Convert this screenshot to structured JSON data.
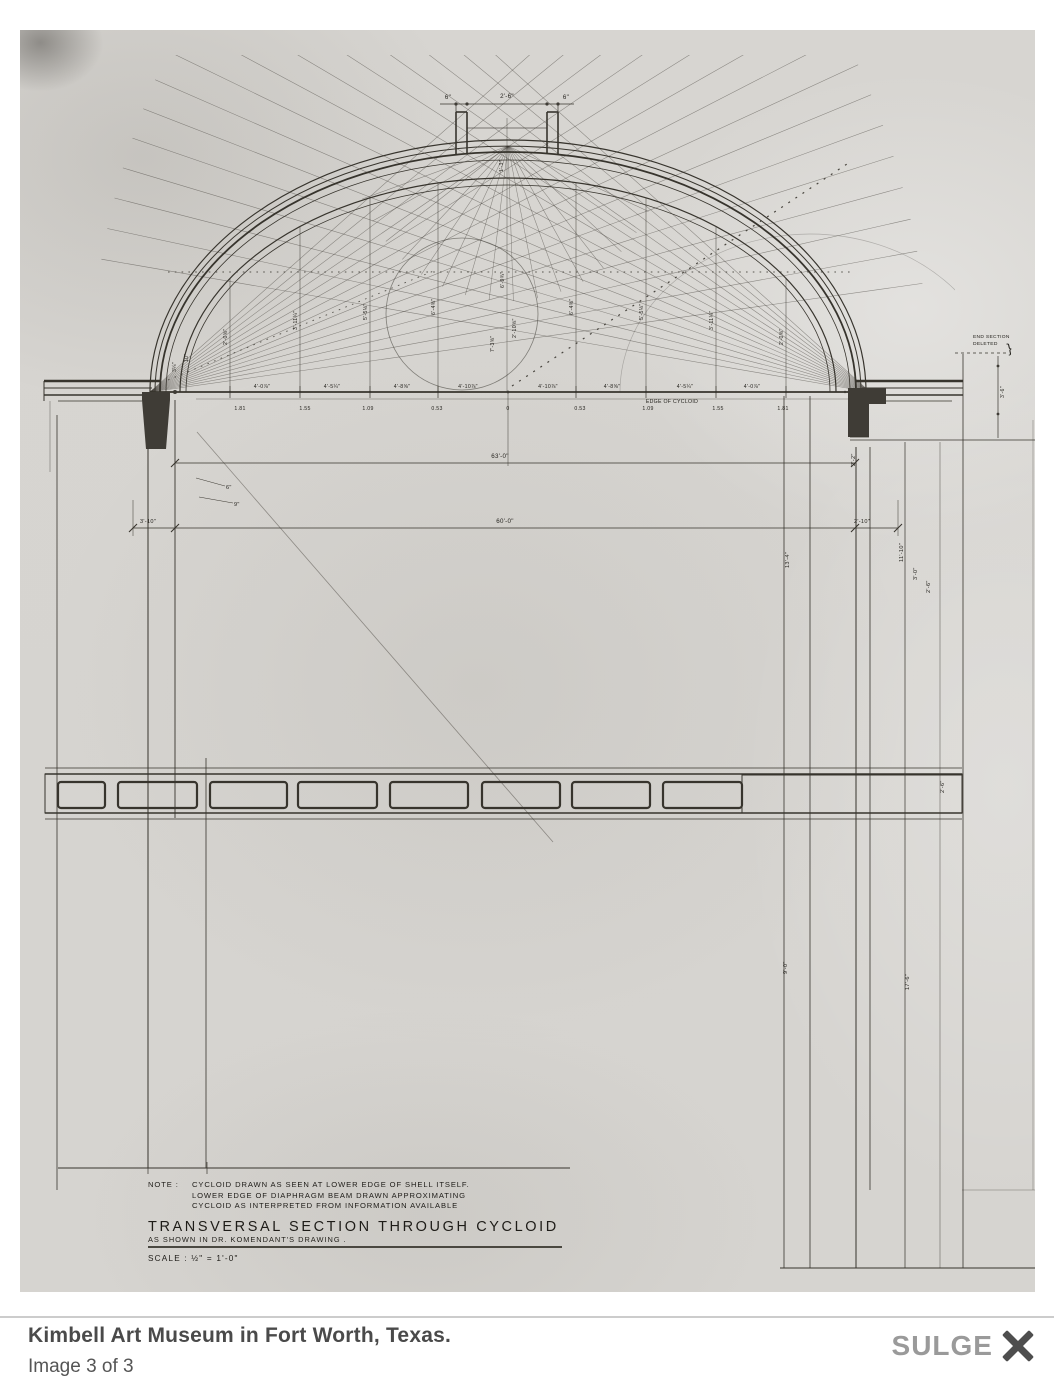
{
  "colors": {
    "paper": "#d6d4d0",
    "ink": "#37342d",
    "caption_text": "#4a4a4a",
    "counter_text": "#555555",
    "brand_gray": "#9a9a9a",
    "close_icon": "#4e4e4e",
    "divider": "#cccccc"
  },
  "caption": {
    "title": "Kimbell Art Museum in Fort Worth, Texas.",
    "counter": "Image 3 of 3",
    "brand": "SULGE"
  },
  "drawing": {
    "note_label": "NOTE :",
    "note_lines": [
      "CYCLOID DRAWN AS SEEN AT LOWER EDGE OF SHELL ITSELF.",
      "LOWER EDGE OF DIAPHRAGM BEAM DRAWN APPROXIMATING",
      "CYCLOID AS INTERPRETED FROM INFORMATION AVAILABLE"
    ],
    "title": "TRANSVERSAL SECTION THROUGH CYCLOID",
    "title_note": "AS SHOWN IN DR. KOMENDANT'S DRAWING .",
    "scale": "SCALE :  ½\" = 1'-0\"",
    "top_dims": [
      "6\"",
      "2'-6\"",
      "6\""
    ],
    "skylight_center": "1'-3\"",
    "span_total": "63'-0\"",
    "span_left": "3'-10\"",
    "span_clear": "60'-0\"",
    "span_right": "2'-10\"",
    "end_note": [
      "END SECTION",
      "DELETED"
    ],
    "end_dim": "3'-6\"",
    "edge_label": "EDGE OF CYCLOID",
    "spring_top": [
      "4'-0⅞\"",
      "4'-5¼\"",
      "4'-8⅝\"",
      "4'-10⅞\"",
      "4'-10⅞\"",
      "4'-8⅝\"",
      "4'-5¼\"",
      "4'-0⅞\""
    ],
    "spring_bottom": [
      "1.81",
      "1.55",
      "1.09",
      "0.53",
      "0",
      "0.53",
      "1.09",
      "1.55",
      "1.81"
    ],
    "rise_labels": [
      "2'-0⅝\"",
      "3'-11¼\"",
      "5'-5⅛\"",
      "6'-4⅜\"",
      "6'-9¾\"",
      "6'-4⅜\"",
      "5'-5⅛\"",
      "3'-11¼\"",
      "2'-0⅝\""
    ],
    "center_labels": [
      "7'-3⅝\"",
      "2'-10⅝\""
    ],
    "haunch_labels": [
      "3¼\"",
      "10\""
    ],
    "wall_details": [
      "6\"",
      "9\""
    ],
    "right_labels": [
      "13'-4\"",
      "11'-10\"",
      "3'-0\"",
      "2'-6\"",
      "2'-2\"",
      "9'-0\"",
      "17'-6\"",
      "2'-6\""
    ]
  }
}
